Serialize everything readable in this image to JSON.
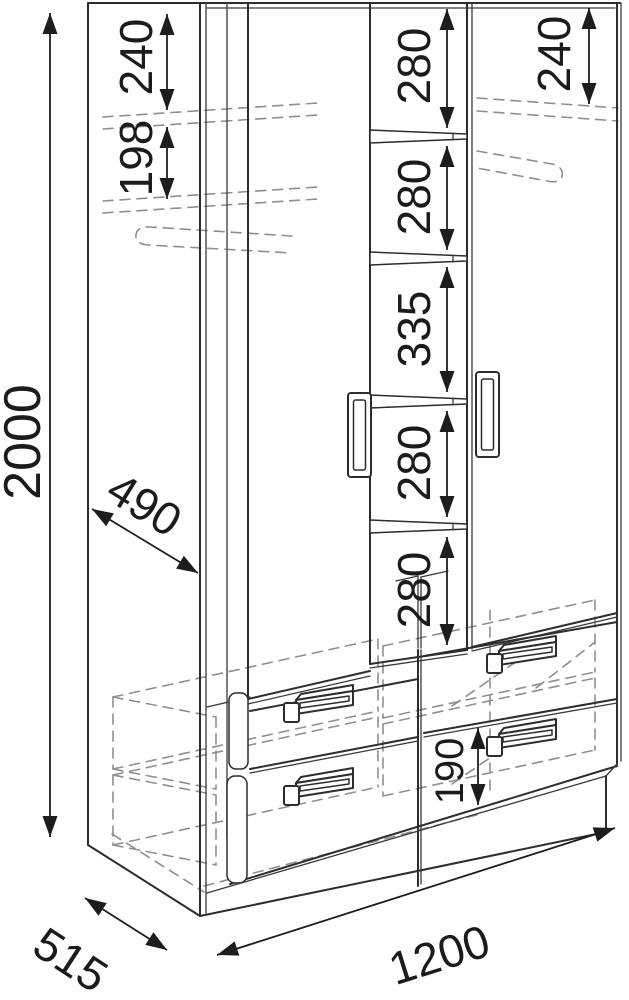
{
  "diagram": {
    "dims": {
      "overall_height": "2000",
      "overall_width": "1200",
      "overall_depth": "515",
      "inner_depth": "490",
      "left_top_gap": "240",
      "left_shelf_to_rod": "198",
      "right_top_gap": "240",
      "center_gaps": [
        "280",
        "280",
        "335",
        "280",
        "280"
      ],
      "drawer_height": "190"
    }
  }
}
